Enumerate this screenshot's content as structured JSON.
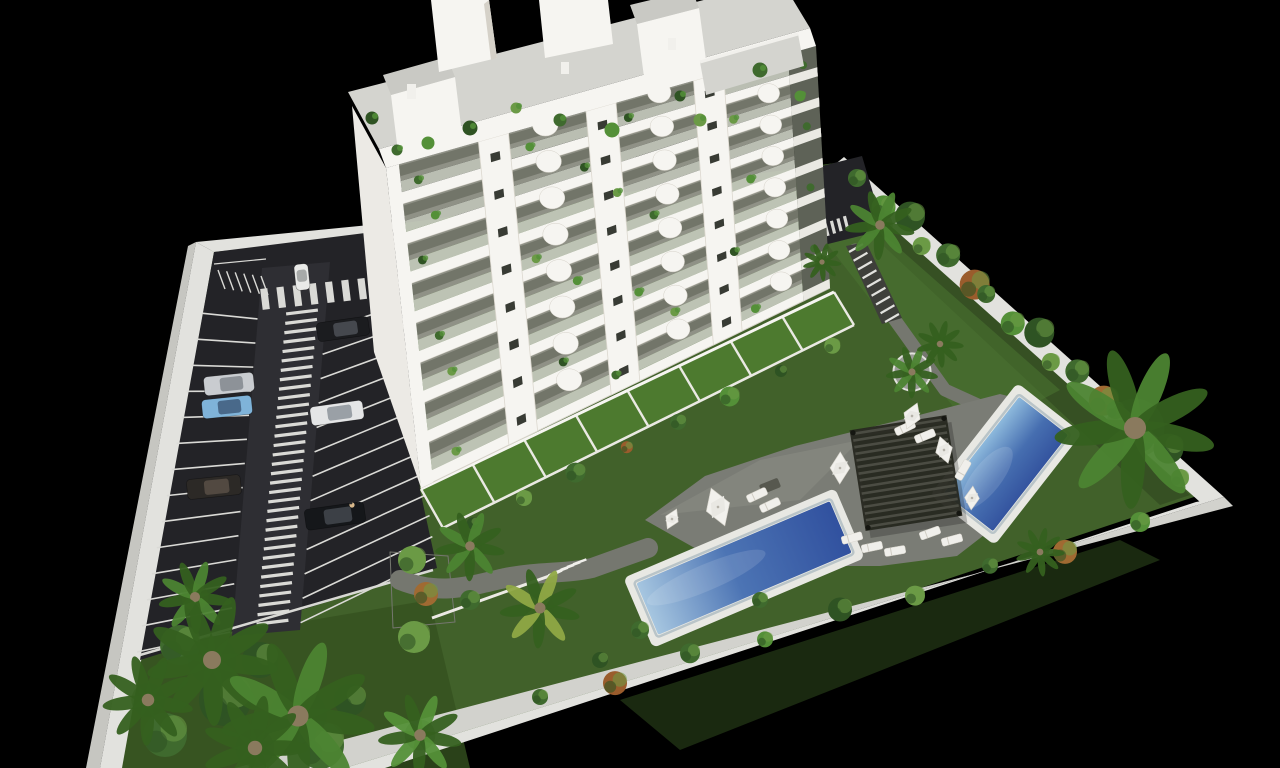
{
  "scene": {
    "description": "Aerial 3D architectural render on a black background: a white multi-storey apartment block with plant-filled balconies, a striped parking lot with cars on the left, landscaped gardens with palm trees inside white perimeter walls, a dark slatted pergola with white parasols and sun loungers, and two rectangular blue swimming pools",
    "width": 1280,
    "height": 768
  },
  "colors": {
    "background": "#000000",
    "grass": "#41612a",
    "grass_dark": "#34511f",
    "grass_light": "#4b7431",
    "grass_shadow": "#2e4520",
    "wall_top": "#e2e2de",
    "wall_face": "#c6c6c1",
    "wall_face_light": "#d2d2cd",
    "asphalt": "#232327",
    "lane": "#2e2e33",
    "marking": "#dadad6",
    "path": "#75776f",
    "deck": "#7a7c75",
    "deck_light": "#8b8d86",
    "curb": "#eceae4",
    "pool_rim": "#e8e8e3",
    "pool_step": "#b9c4c8",
    "pool_shallow": "#a6c6e0",
    "pool_mid": "#4c74b4",
    "pool_deep": "#31519f",
    "pergola": "#26271f",
    "pergola_slat": "#4b4c43",
    "facade_white": "#f6f5f1",
    "facade_recess": "#8f9186",
    "facade_recess_dark": "#6d7064",
    "facade_rail": "#c4c8bc",
    "slab_shadow": "#d5d1c8",
    "window": "#383b34",
    "corner_glass": "#5e6257",
    "gable": "#eceae5",
    "roof_plane": "#d4d4cf",
    "roof_top": "#c9c9c4",
    "terrace_grass": "#4d7a2f",
    "terrace_wall": "#eae9e3",
    "planter": "#9b9d97",
    "plant_dark": "#2f5323",
    "plant_mid": "#3f6a2e",
    "plant_light": "#549038",
    "plant_lush": "#6b9a46",
    "plant_red": "#9a5c2c",
    "plant_rust": "#a06a32",
    "palm_green": "#4c8432",
    "palm_deep": "#35601f",
    "palm_yellow": "#8fa844",
    "trunk": "#8a7a5e",
    "umbrella": "#f2f1ed",
    "lounger": "#f0efeb",
    "table": "#57584f",
    "person_skin": "#d9b98c"
  },
  "building": {
    "floors_visible": 8,
    "pier_columns": 3,
    "curved_balconies_per_floor": 3,
    "gable_window_rows": 7,
    "gable_window_cols": 2,
    "ground_floor_terraces": 8,
    "balcony_plants": true
  },
  "parking": {
    "left_stall_lines": 14,
    "right_stall_lines": 13,
    "crosswalk_rungs": 34,
    "top_zebra_stripes": 7,
    "moto_ticks": 6,
    "cars": [
      {
        "name": "car-white-moving",
        "color": "#e9eae8",
        "cabin": "#a7aaa9",
        "cx": 302,
        "cy": 277,
        "len": 26,
        "wid": 14,
        "rot": -96
      },
      {
        "name": "car-black",
        "color": "#1b1c1f",
        "cabin": "#45484e",
        "cx": 343,
        "cy": 329,
        "len": 52,
        "wid": 19,
        "rot": -8
      },
      {
        "name": "car-silver",
        "color": "#c9ccd0",
        "cabin": "#8d9298",
        "cx": 229,
        "cy": 384,
        "len": 50,
        "wid": 19,
        "rot": -6
      },
      {
        "name": "car-blue",
        "color": "#7fb3d9",
        "cabin": "#49698a",
        "cx": 227,
        "cy": 407,
        "len": 50,
        "wid": 19,
        "rot": -6
      },
      {
        "name": "car-white-2",
        "color": "#e4e5e6",
        "cabin": "#9aa0a6",
        "cx": 337,
        "cy": 413,
        "len": 53,
        "wid": 19,
        "rot": -8
      },
      {
        "name": "car-dark-brown",
        "color": "#2c2926",
        "cabin": "#524941",
        "cx": 214,
        "cy": 487,
        "len": 54,
        "wid": 20,
        "rot": -6
      },
      {
        "name": "car-black-2",
        "color": "#15171a",
        "cabin": "#3c4046",
        "cx": 335,
        "cy": 516,
        "len": 60,
        "wid": 21,
        "rot": -8
      },
      {
        "name": "car-white-parked",
        "color": "#e8e8e6",
        "cabin": "#a8aaa8",
        "cx": 838,
        "cy": 206,
        "len": 24,
        "wid": 14,
        "rot": -98
      }
    ],
    "pedestrian_by_car": {
      "x": 352,
      "y": 505
    }
  },
  "pools": [
    {
      "name": "pool-main-long",
      "cx": 744,
      "cy": 568,
      "length": 214,
      "width": 60,
      "rot": -23
    },
    {
      "name": "pool-upper",
      "cx": 1006,
      "cy": 464,
      "length": 126,
      "width": 66,
      "rot": -52
    }
  ],
  "pergola": {
    "cx": 906,
    "cy": 473,
    "w": 98,
    "h": 102,
    "rot": -9,
    "slats": 15
  },
  "umbrellas": [
    {
      "cx": 718,
      "cy": 507,
      "r": 20
    },
    {
      "cx": 840,
      "cy": 468,
      "r": 16
    },
    {
      "cx": 912,
      "cy": 416,
      "r": 14
    },
    {
      "cx": 944,
      "cy": 450,
      "r": 14
    },
    {
      "cx": 972,
      "cy": 498,
      "r": 12
    },
    {
      "cx": 672,
      "cy": 519,
      "r": 11
    }
  ],
  "loungers": [
    [
      757,
      495,
      -25
    ],
    [
      770,
      505,
      -25
    ],
    [
      852,
      538,
      -15
    ],
    [
      872,
      547,
      -12
    ],
    [
      895,
      551,
      -10
    ],
    [
      930,
      533,
      -20
    ],
    [
      952,
      540,
      -15
    ],
    [
      905,
      428,
      -25
    ],
    [
      925,
      436,
      -22
    ],
    [
      963,
      470,
      -60
    ]
  ],
  "table": {
    "x": 770,
    "y": 486,
    "rot": -22
  },
  "palms": [
    {
      "x": 195,
      "y": 597,
      "r": 42,
      "tone": "green"
    },
    {
      "x": 212,
      "y": 660,
      "r": 75,
      "tone": "deep"
    },
    {
      "x": 298,
      "y": 716,
      "r": 88,
      "tone": "green"
    },
    {
      "x": 148,
      "y": 700,
      "r": 52,
      "tone": "deep"
    },
    {
      "x": 255,
      "y": 748,
      "r": 60,
      "tone": "deep"
    },
    {
      "x": 420,
      "y": 735,
      "r": 48,
      "tone": "light"
    },
    {
      "x": 470,
      "y": 546,
      "r": 40,
      "tone": "green"
    },
    {
      "x": 540,
      "y": 608,
      "r": 46,
      "tone": "yellow"
    },
    {
      "x": 912,
      "y": 372,
      "r": 30,
      "tone": "green",
      "planter": true
    },
    {
      "x": 940,
      "y": 344,
      "r": 27,
      "tone": "deep"
    },
    {
      "x": 880,
      "y": 225,
      "r": 40,
      "tone": "green"
    },
    {
      "x": 822,
      "y": 262,
      "r": 22,
      "tone": "deep"
    },
    {
      "x": 1135,
      "y": 428,
      "r": 92,
      "tone": "green"
    },
    {
      "x": 1040,
      "y": 552,
      "r": 28,
      "tone": "deep"
    }
  ],
  "vegetation": {
    "hedge_ne_shrubs": 16,
    "hedge_south_shrubs": 9,
    "lawn_shrubs": 7,
    "bottom_left_cluster": 6,
    "terrace_edge_shrubs": 8,
    "roofline_plants": 11
  },
  "stairs": {
    "garden_steps": 5,
    "ne_steps": 9,
    "ne_zebra_stripes": 5
  }
}
